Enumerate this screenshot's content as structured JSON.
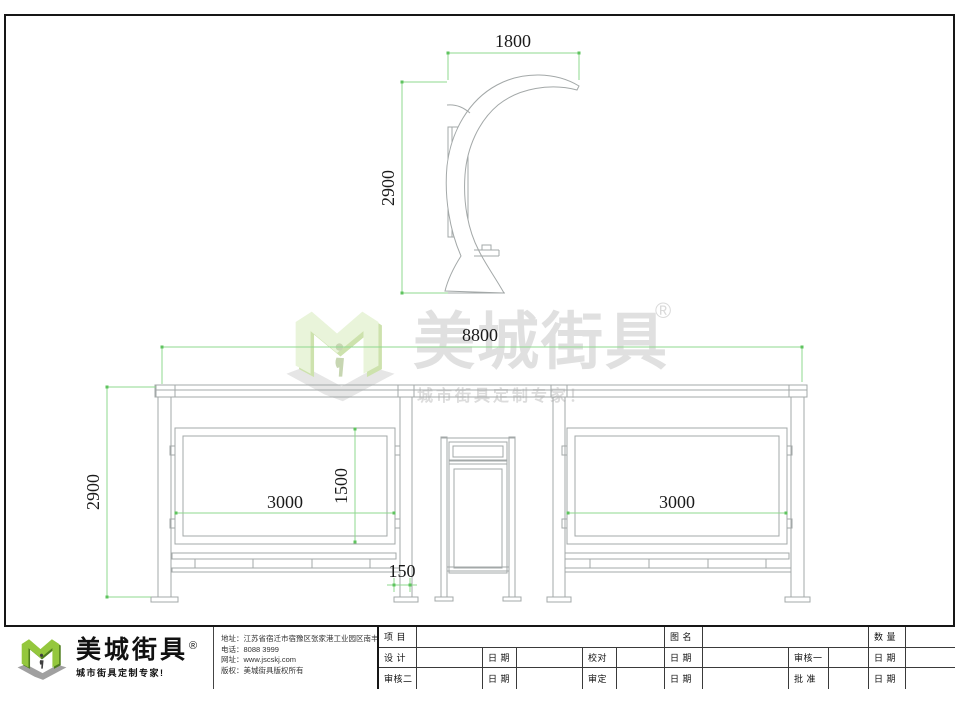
{
  "colors": {
    "dimension_green": "#8fd98f",
    "dimension_tick_green": "#5fc35f",
    "logo_green_light": "#94c73d",
    "logo_green_dark": "#4f7d1e",
    "drawing_line_gray": "#a3a8a8"
  },
  "watermark": {
    "brand": "美城街具",
    "registered": "®",
    "tagline": "城市街具定制专家！"
  },
  "dimensions": {
    "side_width": "1800",
    "side_height": "2900",
    "front_width": "8800",
    "front_height": "2900",
    "left_panel_width": "3000",
    "right_panel_width": "3000",
    "panel_height": "1500",
    "panel_gap": "150"
  },
  "title_block": {
    "brand": "美城街具",
    "registered": "®",
    "tagline": "城市街具定制专家!",
    "contact": {
      "address": "地址：江苏省宿迁市宿豫区张家港工业园区南丰路西侧1号",
      "phone": "电话：8088 3999",
      "website": "网址：www.jscskj.com",
      "copyright": "版权：美城街具版权所有"
    },
    "table": {
      "project": "项 目",
      "drawing_name": "图 名",
      "quantity": "数 量",
      "design": "设 计",
      "date": "日 期",
      "check": "校对",
      "review1": "审核一",
      "review2": "审核二",
      "approve": "审定",
      "ratify": "批 准"
    }
  }
}
